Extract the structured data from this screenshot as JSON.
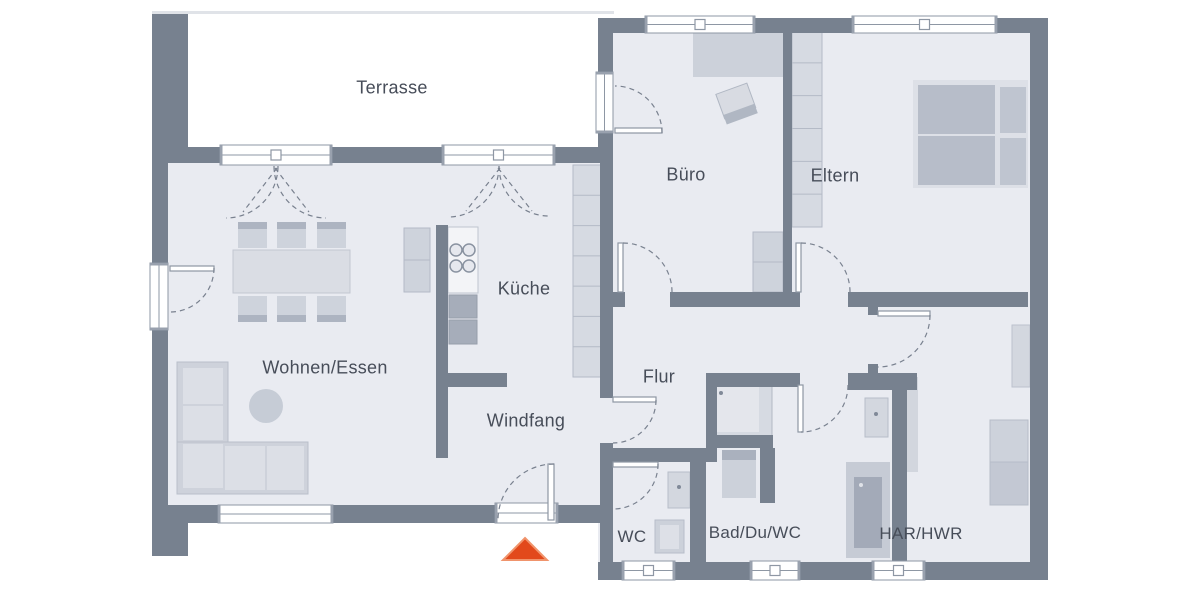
{
  "plan": {
    "canvas": {
      "w": 1200,
      "h": 600
    },
    "colors": {
      "background": "#ffffff",
      "floor": "#e9ebf1",
      "wall": "#77818f",
      "frame_stroke": "#8e97a4",
      "frame_tick": "#99a1ae",
      "arc_stroke": "#79818f",
      "label": "#474d59",
      "arrow_fill": "#e2491b",
      "arrow_edge": "#f0946c",
      "furniture_light": "#d6dae2",
      "furniture_mid": "#ced3dc",
      "furniture_dark": "#a6adba"
    },
    "rooms": [
      {
        "id": "terrasse",
        "label": "Terrasse",
        "cx": 392,
        "cy": 88,
        "fs": 18
      },
      {
        "id": "wohnen",
        "label": "Wohnen/Essen",
        "cx": 325,
        "cy": 368,
        "fs": 18
      },
      {
        "id": "kueche",
        "label": "Küche",
        "cx": 524,
        "cy": 289,
        "fs": 18
      },
      {
        "id": "windfang",
        "label": "Windfang",
        "cx": 526,
        "cy": 421,
        "fs": 18
      },
      {
        "id": "flur",
        "label": "Flur",
        "cx": 659,
        "cy": 377,
        "fs": 18
      },
      {
        "id": "buero",
        "label": "Büro",
        "cx": 686,
        "cy": 175,
        "fs": 18
      },
      {
        "id": "eltern",
        "label": "Eltern",
        "cx": 835,
        "cy": 176,
        "fs": 18
      },
      {
        "id": "wc",
        "label": "WC",
        "cx": 632,
        "cy": 537,
        "fs": 17
      },
      {
        "id": "bad",
        "label": "Bad/Du/WC",
        "cx": 755,
        "cy": 533,
        "fs": 17
      },
      {
        "id": "har",
        "label": "HAR/HWR",
        "cx": 921,
        "cy": 534,
        "fs": 17
      }
    ],
    "floors": [
      [
        168,
        158,
        445,
        347
      ],
      [
        598,
        33,
        432,
        529
      ]
    ],
    "walls": [
      [
        152,
        14,
        36,
        144
      ],
      [
        152,
        158,
        16,
        347
      ],
      [
        152,
        505,
        36,
        51
      ],
      [
        168,
        147,
        445,
        16
      ],
      [
        152,
        505,
        461,
        18
      ],
      [
        598,
        18,
        450,
        15
      ],
      [
        1030,
        18,
        18,
        562
      ],
      [
        598,
        562,
        450,
        18
      ],
      [
        598,
        18,
        15,
        129
      ],
      [
        600,
        147,
        13,
        251
      ],
      [
        600,
        443,
        13,
        137
      ],
      [
        613,
        292,
        12,
        15
      ],
      [
        670,
        292,
        113,
        15
      ],
      [
        783,
        292,
        17,
        15
      ],
      [
        848,
        292,
        180,
        15
      ],
      [
        783,
        28,
        9,
        269
      ],
      [
        436,
        225,
        12,
        233
      ],
      [
        448,
        373,
        59,
        14
      ],
      [
        706,
        373,
        94,
        14
      ],
      [
        848,
        373,
        69,
        17
      ],
      [
        868,
        307,
        10,
        8
      ],
      [
        868,
        364,
        10,
        11
      ],
      [
        605,
        448,
        112,
        14
      ],
      [
        706,
        373,
        11,
        89
      ],
      [
        690,
        448,
        16,
        115
      ],
      [
        892,
        377,
        15,
        193
      ],
      [
        706,
        435,
        67,
        13
      ],
      [
        760,
        448,
        15,
        55
      ]
    ],
    "furniture": [
      {
        "t": "r",
        "n": "terrace-slab-edge",
        "x": 152,
        "y": 11,
        "w": 462,
        "h": 3,
        "f": "#e0e3e8"
      },
      {
        "t": "r",
        "n": "har-wall-shadow",
        "x": 907,
        "y": 377,
        "w": 11,
        "h": 95,
        "f": "#d2d6de"
      },
      {
        "t": "cells",
        "n": "kitchen-counter",
        "x": 573,
        "y": 165,
        "w": 28,
        "h": 212,
        "nseg": 7,
        "f": "#d6dae2",
        "lc": "#b4bac6"
      },
      {
        "t": "r",
        "n": "kitchen-island",
        "x": 448,
        "y": 227,
        "w": 30,
        "h": 66,
        "f": "#f3f4f7",
        "s": "#bfc5cf"
      },
      {
        "t": "c",
        "n": "cooktop-burner",
        "cx": 456,
        "cy": 250,
        "r": 6,
        "f": "#e6e8ee",
        "s": "#8a93a1"
      },
      {
        "t": "c",
        "n": "cooktop-burner",
        "cx": 469,
        "cy": 250,
        "r": 6,
        "f": "#e6e8ee",
        "s": "#8a93a1"
      },
      {
        "t": "c",
        "n": "cooktop-burner",
        "cx": 456,
        "cy": 266,
        "r": 6,
        "f": "#e6e8ee",
        "s": "#8a93a1"
      },
      {
        "t": "c",
        "n": "cooktop-burner",
        "cx": 469,
        "cy": 266,
        "r": 6,
        "f": "#e6e8ee",
        "s": "#8a93a1"
      },
      {
        "t": "r",
        "n": "oven",
        "x": 449,
        "y": 295,
        "w": 28,
        "h": 23,
        "f": "#a6adba",
        "s": "#979eab"
      },
      {
        "t": "r",
        "n": "oven",
        "x": 449,
        "y": 320,
        "w": 28,
        "h": 24,
        "f": "#a6adba",
        "s": "#979eab"
      },
      {
        "t": "cells",
        "n": "sideboard",
        "x": 404,
        "y": 228,
        "w": 26,
        "h": 64,
        "nseg": 2,
        "f": "#ced3dc",
        "lc": "#b4bac6"
      },
      {
        "t": "r",
        "n": "dining-table",
        "x": 233,
        "y": 250,
        "w": 117,
        "h": 43,
        "f": "#dadde4",
        "s": "#c2c7d1"
      },
      {
        "t": "r",
        "n": "chair",
        "x": 238,
        "y": 222,
        "w": 29,
        "h": 26,
        "f": "#ced3dc"
      },
      {
        "t": "r",
        "n": "chair-backrest",
        "x": 238,
        "y": 222,
        "w": 29,
        "h": 7,
        "f": "#adb4c1"
      },
      {
        "t": "r",
        "n": "chair",
        "x": 277,
        "y": 222,
        "w": 29,
        "h": 26,
        "f": "#ced3dc"
      },
      {
        "t": "r",
        "n": "chair-backrest",
        "x": 277,
        "y": 222,
        "w": 29,
        "h": 7,
        "f": "#adb4c1"
      },
      {
        "t": "r",
        "n": "chair",
        "x": 317,
        "y": 222,
        "w": 29,
        "h": 26,
        "f": "#ced3dc"
      },
      {
        "t": "r",
        "n": "chair-backrest",
        "x": 317,
        "y": 222,
        "w": 29,
        "h": 7,
        "f": "#adb4c1"
      },
      {
        "t": "r",
        "n": "chair",
        "x": 238,
        "y": 296,
        "w": 29,
        "h": 26,
        "f": "#ced3dc"
      },
      {
        "t": "r",
        "n": "chair-backrest",
        "x": 238,
        "y": 315,
        "w": 29,
        "h": 7,
        "f": "#adb4c1"
      },
      {
        "t": "r",
        "n": "chair",
        "x": 277,
        "y": 296,
        "w": 29,
        "h": 26,
        "f": "#ced3dc"
      },
      {
        "t": "r",
        "n": "chair-backrest",
        "x": 277,
        "y": 315,
        "w": 29,
        "h": 7,
        "f": "#adb4c1"
      },
      {
        "t": "r",
        "n": "chair",
        "x": 317,
        "y": 296,
        "w": 29,
        "h": 26,
        "f": "#ced3dc"
      },
      {
        "t": "r",
        "n": "chair-backrest",
        "x": 317,
        "y": 315,
        "w": 29,
        "h": 7,
        "f": "#adb4c1"
      },
      {
        "t": "r",
        "n": "sofa",
        "x": 177,
        "y": 362,
        "w": 51,
        "h": 132,
        "f": "#ced2db",
        "s": "#b9bfca"
      },
      {
        "t": "r",
        "n": "sofa",
        "x": 177,
        "y": 442,
        "w": 131,
        "h": 52,
        "f": "#ced2db",
        "s": "#b9bfca"
      },
      {
        "t": "r",
        "n": "sofa-cushion",
        "x": 183,
        "y": 368,
        "w": 40,
        "h": 36,
        "f": "#dcdfe6"
      },
      {
        "t": "r",
        "n": "sofa-cushion",
        "x": 183,
        "y": 406,
        "w": 40,
        "h": 34,
        "f": "#dcdfe6"
      },
      {
        "t": "r",
        "n": "sofa-cushion",
        "x": 183,
        "y": 444,
        "w": 40,
        "h": 44,
        "f": "#dcdfe6"
      },
      {
        "t": "r",
        "n": "sofa-cushion",
        "x": 225,
        "y": 446,
        "w": 40,
        "h": 44,
        "f": "#dcdfe6"
      },
      {
        "t": "r",
        "n": "sofa-cushion",
        "x": 267,
        "y": 446,
        "w": 37,
        "h": 44,
        "f": "#dcdfe6"
      },
      {
        "t": "c",
        "n": "coffee-table",
        "cx": 266,
        "cy": 406,
        "r": 17,
        "f": "#c6ccd6"
      },
      {
        "t": "r",
        "n": "desk",
        "x": 693,
        "y": 32,
        "w": 90,
        "h": 45,
        "f": "#ccd1da"
      },
      {
        "t": "r",
        "n": "desk-chair",
        "x": 720,
        "y": 88,
        "w": 33,
        "h": 26,
        "f": "#d8dbe2",
        "s": "#b0b7c3",
        "rot": "-20 736 103"
      },
      {
        "t": "r",
        "n": "desk-chair-back",
        "x": 720,
        "y": 110,
        "w": 33,
        "h": 10,
        "f": "#b0b7c3",
        "rot": "-20 736 103"
      },
      {
        "t": "cells",
        "n": "buero-cabinet",
        "x": 753,
        "y": 232,
        "w": 30,
        "h": 60,
        "nseg": 2,
        "f": "#ced3dc",
        "lc": "#b4bac6"
      },
      {
        "t": "cells",
        "n": "wardrobe",
        "x": 792,
        "y": 30,
        "w": 30,
        "h": 197,
        "nseg": 6,
        "f": "#d6dae2",
        "lc": "#b4bac6"
      },
      {
        "t": "r",
        "n": "bed-frame",
        "x": 913,
        "y": 80,
        "w": 115,
        "h": 108,
        "f": "#dde0e7"
      },
      {
        "t": "r",
        "n": "bed-mattress",
        "x": 918,
        "y": 85,
        "w": 77,
        "h": 49,
        "f": "#b7bdc9"
      },
      {
        "t": "r",
        "n": "bed-mattress",
        "x": 918,
        "y": 136,
        "w": 77,
        "h": 49,
        "f": "#b7bdc9"
      },
      {
        "t": "r",
        "n": "bed-pillow",
        "x": 1000,
        "y": 87,
        "w": 26,
        "h": 46,
        "f": "#bfc5d0"
      },
      {
        "t": "r",
        "n": "bed-pillow",
        "x": 1000,
        "y": 138,
        "w": 26,
        "h": 47,
        "f": "#bfc5d0"
      },
      {
        "t": "r",
        "n": "wc-toilet",
        "x": 668,
        "y": 472,
        "w": 22,
        "h": 36,
        "f": "#d3d7df",
        "s": "#b7bdc9"
      },
      {
        "t": "c",
        "n": "wc-toilet-dot",
        "cx": 679,
        "cy": 487,
        "r": 2,
        "f": "#808998"
      },
      {
        "t": "r",
        "n": "wc-sink",
        "x": 655,
        "y": 520,
        "w": 29,
        "h": 33,
        "f": "#ccd1da",
        "s": "#b7bdc9"
      },
      {
        "t": "r",
        "n": "wc-sink-basin",
        "x": 660,
        "y": 525,
        "w": 19,
        "h": 24,
        "f": "#dde0e7"
      },
      {
        "t": "r",
        "n": "bathtub",
        "x": 710,
        "y": 381,
        "w": 62,
        "h": 56,
        "f": "#d6dae2",
        "s": "#b2b8c4"
      },
      {
        "t": "r",
        "n": "bathtub-inner",
        "x": 715,
        "y": 386,
        "w": 44,
        "h": 46,
        "f": "#e4e6ec"
      },
      {
        "t": "c",
        "n": "bathtub-drain",
        "cx": 721,
        "cy": 393,
        "r": 2,
        "f": "#808998"
      },
      {
        "t": "r",
        "n": "bad-sink-top",
        "x": 722,
        "y": 450,
        "w": 34,
        "h": 10,
        "f": "#aab1be"
      },
      {
        "t": "r",
        "n": "bad-sink",
        "x": 722,
        "y": 460,
        "w": 34,
        "h": 38,
        "f": "#ccd1da"
      },
      {
        "t": "r",
        "n": "bad-toilet",
        "x": 865,
        "y": 398,
        "w": 23,
        "h": 39,
        "f": "#d3d7df",
        "s": "#b7bdc9"
      },
      {
        "t": "c",
        "n": "bad-toilet-dot",
        "cx": 876,
        "cy": 414,
        "r": 2,
        "f": "#808998"
      },
      {
        "t": "r",
        "n": "shower",
        "x": 846,
        "y": 462,
        "w": 44,
        "h": 96,
        "f": "#c6cbd5"
      },
      {
        "t": "r",
        "n": "shower-tray",
        "x": 854,
        "y": 477,
        "w": 28,
        "h": 71,
        "f": "#a3aab8"
      },
      {
        "t": "c",
        "n": "shower-drain",
        "cx": 861,
        "cy": 485,
        "r": 2,
        "f": "#dfe2e8"
      },
      {
        "t": "r",
        "n": "har-cabinet",
        "x": 1012,
        "y": 325,
        "w": 18,
        "h": 62,
        "f": "#d3d7df",
        "s": "#bcc2cd"
      },
      {
        "t": "r",
        "n": "washer",
        "x": 990,
        "y": 420,
        "w": 38,
        "h": 42,
        "f": "#cdd2db",
        "s": "#b6bcc8"
      },
      {
        "t": "r",
        "n": "dryer",
        "x": 990,
        "y": 462,
        "w": 38,
        "h": 43,
        "f": "#c3c8d3",
        "s": "#b6bcc8"
      }
    ],
    "windows": [
      {
        "n": "terrace-door-left",
        "x": 220,
        "y": 145,
        "w": 112,
        "h": 20,
        "o": "h",
        "mark": true
      },
      {
        "n": "terrace-door-right",
        "x": 442,
        "y": 145,
        "w": 113,
        "h": 20,
        "o": "h",
        "mark": true
      },
      {
        "n": "living-west-door",
        "x": 150,
        "y": 263,
        "w": 18,
        "h": 67,
        "o": "v",
        "mark": false
      },
      {
        "n": "living-south-window",
        "x": 218,
        "y": 505,
        "w": 115,
        "h": 18,
        "o": "h",
        "mark": false
      },
      {
        "n": "entrance-door-frame",
        "x": 495,
        "y": 503,
        "w": 63,
        "h": 20,
        "o": "h",
        "mark": false
      },
      {
        "n": "buero-terrace-door",
        "x": 596,
        "y": 72,
        "w": 17,
        "h": 61,
        "o": "v",
        "mark": false
      },
      {
        "n": "buero-north-window",
        "x": 645,
        "y": 16,
        "w": 110,
        "h": 17,
        "o": "h",
        "mark": true
      },
      {
        "n": "eltern-north-window",
        "x": 852,
        "y": 16,
        "w": 145,
        "h": 17,
        "o": "h",
        "mark": true
      },
      {
        "n": "wc-south-window",
        "x": 622,
        "y": 561,
        "w": 53,
        "h": 19,
        "o": "h",
        "mark": true
      },
      {
        "n": "bad-south-window",
        "x": 750,
        "y": 561,
        "w": 50,
        "h": 19,
        "o": "h",
        "mark": true
      },
      {
        "n": "har-south-window",
        "x": 872,
        "y": 561,
        "w": 53,
        "h": 19,
        "o": "h",
        "mark": true
      }
    ],
    "doors": [
      {
        "n": "terrace-door-left-swing",
        "arc": "M 278 166 A 52 52 0 0 1 226 218"
      },
      {
        "n": "terrace-door-left-swing",
        "arc": "M 274 166 A 52 52 0 0 0 326 218"
      },
      {
        "n": "terrace-door-left-leaf-line",
        "arc": "M 277 168 L 243 212"
      },
      {
        "n": "terrace-door-left-leaf-line",
        "arc": "M 275 168 L 309 212"
      },
      {
        "n": "terrace-door-right-swing",
        "arc": "M 499 166 A 51 51 0 0 1 448 217"
      },
      {
        "n": "terrace-door-right-swing",
        "arc": "M 499 166 A 50 50 0 0 0 549 216"
      },
      {
        "n": "terrace-door-right-leaf-line",
        "arc": "M 500 168 L 466 211"
      },
      {
        "n": "terrace-door-right-leaf-line",
        "arc": "M 498 168 L 532 211"
      },
      {
        "n": "living-west-door-swing",
        "arc": "M 214 268 A 44 44 0 0 1 170 312",
        "leaf": [
          170,
          266,
          44,
          5
        ]
      },
      {
        "n": "buero-terrace-door-swing",
        "arc": "M 662 133 A 47 47 0 0 0 615 86",
        "leaf": [
          615,
          128,
          47,
          5
        ]
      },
      {
        "n": "buero-door-swing",
        "arc": "M 623 243 A 49 49 0 0 1 672 292",
        "leaf": [
          618,
          243,
          5,
          49
        ]
      },
      {
        "n": "eltern-door-swing",
        "arc": "M 801 243 A 49 49 0 0 1 850 292",
        "leaf": [
          796,
          243,
          5,
          49
        ]
      },
      {
        "n": "har-door-swing",
        "arc": "M 930 315 A 52 52 0 0 1 878 367",
        "leaf": [
          878,
          311,
          52,
          5
        ]
      },
      {
        "n": "bad-door-swing",
        "arc": "M 848 385 A 47 47 0 0 1 801 432",
        "leaf": [
          798,
          385,
          5,
          47
        ]
      },
      {
        "n": "wc-door-swing",
        "arc": "M 658 464 A 45 45 0 0 1 613 509",
        "leaf": [
          613,
          462,
          45,
          5
        ]
      },
      {
        "n": "flur-door-swing",
        "arc": "M 656 400 A 43 43 0 0 1 613 443",
        "leaf": [
          613,
          397,
          43,
          5
        ]
      },
      {
        "n": "entrance-door-swing",
        "arc": "M 554 464 A 56 56 0 0 0 498 520",
        "leaf": [
          548,
          464,
          6,
          56
        ]
      }
    ],
    "entrance_arrow": {
      "points": "525,538 547,560 503,560"
    }
  }
}
